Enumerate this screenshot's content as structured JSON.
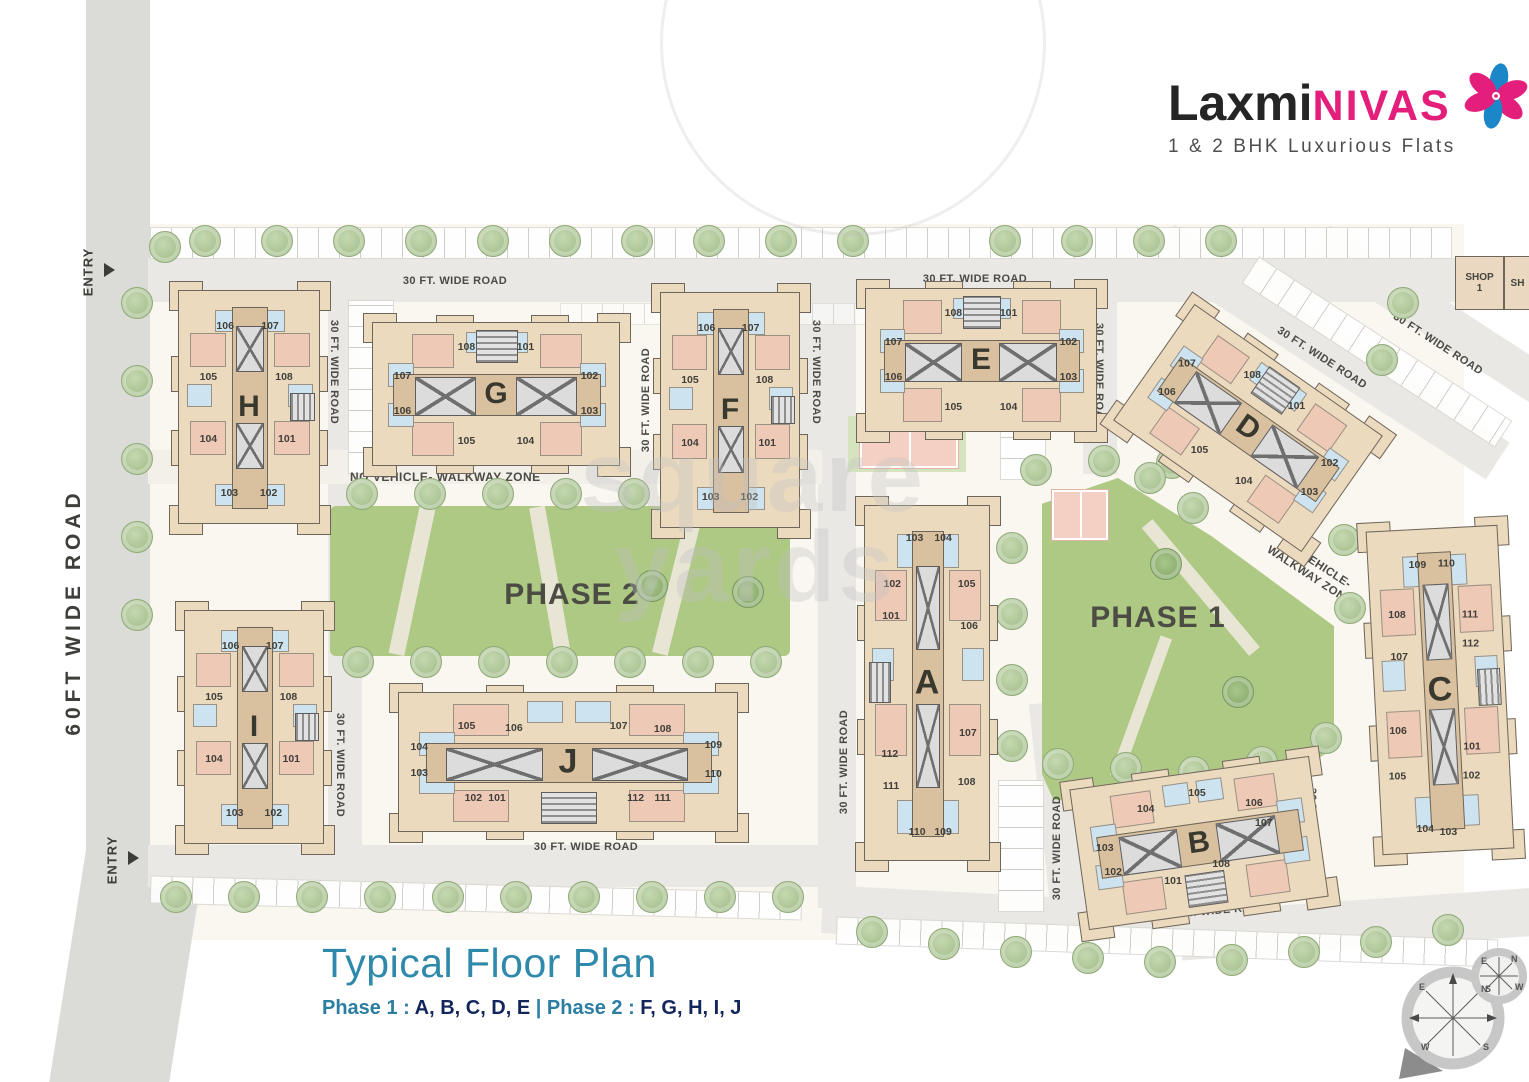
{
  "logo": {
    "name_part1": "Laxmi",
    "name_part2": "NIVAS",
    "tagline": "1 & 2 BHK Luxurious Flats"
  },
  "legend": {
    "title": "Typical Floor Plan",
    "phase1_label": "Phase 1 : ",
    "phase1_buildings": "A, B, C, D, E ",
    "phase2_label": "| Phase 2 : ",
    "phase2_buildings": "F, G, H, I, J"
  },
  "zones": {
    "phase1": "PHASE 1",
    "phase2": "PHASE 2",
    "walkway": "NO VEHICLE- WALKWAY ZONE",
    "walkway_diag_line1": "NO VEHICLE-",
    "walkway_diag_line2": "WALKWAY ZONE"
  },
  "roads": {
    "left_label": "60FT WIDE ROAD",
    "entry_label": "ENTRY",
    "entries": [
      {
        "x": 88,
        "y": 272,
        "ax": 104,
        "ay": 263
      },
      {
        "x": 112,
        "y": 860,
        "ax": 128,
        "ay": 851
      }
    ],
    "labels": [
      {
        "t": "30 FT. WIDE ROAD",
        "x": 455,
        "y": 281,
        "r": 0
      },
      {
        "t": "30 FT. WIDE ROAD",
        "x": 975,
        "y": 279,
        "r": 0
      },
      {
        "t": "30 FT. WIDE ROAD",
        "x": 334,
        "y": 372,
        "r": 90
      },
      {
        "t": "30 FT. WIDE ROAD",
        "x": 646,
        "y": 400,
        "r": -90
      },
      {
        "t": "30 FT. WIDE ROAD",
        "x": 816,
        "y": 372,
        "r": 90
      },
      {
        "t": "30 FT. WIDE ROAD",
        "x": 1099,
        "y": 375,
        "r": 90
      },
      {
        "t": "30 FT. WIDE ROAD",
        "x": 1322,
        "y": 358,
        "r": 33
      },
      {
        "t": "30 FT. WIDE ROAD",
        "x": 1438,
        "y": 344,
        "r": 33
      },
      {
        "t": "30 FT. WIDE ROAD",
        "x": 340,
        "y": 765,
        "r": 90
      },
      {
        "t": "30 FT. WIDE ROAD",
        "x": 586,
        "y": 847,
        "r": 0
      },
      {
        "t": "30 FT. WIDE ROAD",
        "x": 844,
        "y": 762,
        "r": -90
      },
      {
        "t": "30 FT. WIDE ROAD",
        "x": 1057,
        "y": 848,
        "r": -90
      },
      {
        "t": "30 FT. WIDE ROAD",
        "x": 1312,
        "y": 840,
        "r": 90
      },
      {
        "t": "30 FT. WIDE ROAD",
        "x": 1216,
        "y": 911,
        "r": -5
      }
    ]
  },
  "shops": [
    {
      "line1": "SHOP",
      "line2": "1",
      "x": 1455,
      "y": 256,
      "w": 47,
      "h": 52
    },
    {
      "line1": "SH",
      "line2": "",
      "x": 1504,
      "y": 256,
      "w": 25,
      "h": 52
    }
  ],
  "watermark": {
    "line1": "square",
    "line2": "yards"
  },
  "compass": {
    "n": "N",
    "e": "E",
    "s": "S",
    "w": "W"
  },
  "colors": {
    "brand_pink": "#e31f7b",
    "brand_blue": "#1b86c8",
    "title_teal": "#2f89ab",
    "navy": "#13265c",
    "building_tan": "#ecdabf",
    "room_pink": "#eec9b6",
    "room_blue": "#cde3ef",
    "park_green": "#adc983",
    "road_gray": "#e9e8e4"
  },
  "buildings": [
    {
      "id": "H",
      "x": 178,
      "y": 290,
      "w": 142,
      "h": 234,
      "rot": 0,
      "orient": "v",
      "stair": "right",
      "units": [
        {
          "n": "106",
          "x": 33,
          "y": 15
        },
        {
          "n": "107",
          "x": 65,
          "y": 15
        },
        {
          "n": "105",
          "x": 21,
          "y": 37
        },
        {
          "n": "108",
          "x": 75,
          "y": 37
        },
        {
          "n": "104",
          "x": 21,
          "y": 64
        },
        {
          "n": "101",
          "x": 77,
          "y": 64
        },
        {
          "n": "103",
          "x": 36,
          "y": 87
        },
        {
          "n": "102",
          "x": 64,
          "y": 87
        }
      ]
    },
    {
      "id": "G",
      "x": 372,
      "y": 322,
      "w": 248,
      "h": 144,
      "rot": 0,
      "orient": "h",
      "stair": "top",
      "units": [
        {
          "n": "108",
          "x": 38,
          "y": 17
        },
        {
          "n": "101",
          "x": 62,
          "y": 17
        },
        {
          "n": "107",
          "x": 12,
          "y": 37
        },
        {
          "n": "102",
          "x": 88,
          "y": 37
        },
        {
          "n": "106",
          "x": 12,
          "y": 62
        },
        {
          "n": "103",
          "x": 88,
          "y": 62
        },
        {
          "n": "105",
          "x": 38,
          "y": 83
        },
        {
          "n": "104",
          "x": 62,
          "y": 83
        }
      ]
    },
    {
      "id": "F",
      "x": 660,
      "y": 292,
      "w": 140,
      "h": 236,
      "rot": 0,
      "orient": "v",
      "stair": "right",
      "units": [
        {
          "n": "106",
          "x": 33,
          "y": 15
        },
        {
          "n": "107",
          "x": 65,
          "y": 15
        },
        {
          "n": "105",
          "x": 21,
          "y": 37
        },
        {
          "n": "108",
          "x": 75,
          "y": 37
        },
        {
          "n": "104",
          "x": 21,
          "y": 64
        },
        {
          "n": "101",
          "x": 77,
          "y": 64
        },
        {
          "n": "103",
          "x": 36,
          "y": 87
        },
        {
          "n": "102",
          "x": 64,
          "y": 87
        }
      ]
    },
    {
      "id": "E",
      "x": 865,
      "y": 288,
      "w": 232,
      "h": 144,
      "rot": 0,
      "orient": "h",
      "stair": "top",
      "units": [
        {
          "n": "108",
          "x": 38,
          "y": 17
        },
        {
          "n": "101",
          "x": 62,
          "y": 17
        },
        {
          "n": "107",
          "x": 12,
          "y": 37
        },
        {
          "n": "102",
          "x": 88,
          "y": 37
        },
        {
          "n": "106",
          "x": 12,
          "y": 62
        },
        {
          "n": "103",
          "x": 88,
          "y": 62
        },
        {
          "n": "105",
          "x": 38,
          "y": 83
        },
        {
          "n": "104",
          "x": 62,
          "y": 83
        }
      ]
    },
    {
      "id": "D",
      "x": 1133,
      "y": 357,
      "w": 230,
      "h": 142,
      "rot": 35,
      "orient": "h",
      "stair": "top",
      "units": [
        {
          "n": "108",
          "x": 38,
          "y": 17
        },
        {
          "n": "101",
          "x": 62,
          "y": 17
        },
        {
          "n": "107",
          "x": 12,
          "y": 37
        },
        {
          "n": "102",
          "x": 88,
          "y": 37
        },
        {
          "n": "106",
          "x": 12,
          "y": 62
        },
        {
          "n": "103",
          "x": 88,
          "y": 62
        },
        {
          "n": "105",
          "x": 38,
          "y": 83
        },
        {
          "n": "104",
          "x": 62,
          "y": 83
        }
      ]
    },
    {
      "id": "A",
      "x": 864,
      "y": 505,
      "w": 126,
      "h": 356,
      "rot": 0,
      "orient": "v",
      "stair": "left",
      "units": [
        {
          "n": "103",
          "x": 40,
          "y": 9
        },
        {
          "n": "104",
          "x": 63,
          "y": 9
        },
        {
          "n": "102",
          "x": 22,
          "y": 22
        },
        {
          "n": "105",
          "x": 82,
          "y": 22
        },
        {
          "n": "101",
          "x": 21,
          "y": 31
        },
        {
          "n": "106",
          "x": 84,
          "y": 34
        },
        {
          "n": "112",
          "x": 20,
          "y": 70
        },
        {
          "n": "107",
          "x": 83,
          "y": 64
        },
        {
          "n": "111",
          "x": 21,
          "y": 79
        },
        {
          "n": "108",
          "x": 82,
          "y": 78
        },
        {
          "n": "110",
          "x": 42,
          "y": 92
        },
        {
          "n": "109",
          "x": 63,
          "y": 92
        }
      ]
    },
    {
      "id": "B",
      "x": 1078,
      "y": 772,
      "w": 242,
      "h": 142,
      "rot": -8,
      "orient": "h",
      "stair": "bottom",
      "units": [
        {
          "n": "104",
          "x": 30,
          "y": 21
        },
        {
          "n": "105",
          "x": 52,
          "y": 14
        },
        {
          "n": "103",
          "x": 11,
          "y": 44
        },
        {
          "n": "106",
          "x": 75,
          "y": 27
        },
        {
          "n": "102",
          "x": 13,
          "y": 62
        },
        {
          "n": "107",
          "x": 78,
          "y": 42
        },
        {
          "n": "101",
          "x": 37,
          "y": 74
        },
        {
          "n": "108",
          "x": 58,
          "y": 67
        }
      ]
    },
    {
      "id": "C",
      "x": 1374,
      "y": 528,
      "w": 132,
      "h": 324,
      "rot": -3,
      "orient": "v",
      "stair": "right",
      "units": [
        {
          "n": "109",
          "x": 38,
          "y": 11
        },
        {
          "n": "110",
          "x": 60,
          "y": 11
        },
        {
          "n": "108",
          "x": 20,
          "y": 26
        },
        {
          "n": "111",
          "x": 76,
          "y": 27
        },
        {
          "n": "107",
          "x": 20,
          "y": 39
        },
        {
          "n": "112",
          "x": 75,
          "y": 36
        },
        {
          "n": "106",
          "x": 16,
          "y": 62
        },
        {
          "n": "101",
          "x": 72,
          "y": 68
        },
        {
          "n": "105",
          "x": 14,
          "y": 76
        },
        {
          "n": "102",
          "x": 71,
          "y": 77
        },
        {
          "n": "104",
          "x": 33,
          "y": 93
        },
        {
          "n": "103",
          "x": 51,
          "y": 94
        }
      ]
    },
    {
      "id": "I",
      "x": 184,
      "y": 610,
      "w": 140,
      "h": 234,
      "rot": 0,
      "orient": "v",
      "stair": "right",
      "units": [
        {
          "n": "106",
          "x": 33,
          "y": 15
        },
        {
          "n": "107",
          "x": 65,
          "y": 15
        },
        {
          "n": "105",
          "x": 21,
          "y": 37
        },
        {
          "n": "108",
          "x": 75,
          "y": 37
        },
        {
          "n": "104",
          "x": 21,
          "y": 64
        },
        {
          "n": "101",
          "x": 77,
          "y": 64
        },
        {
          "n": "103",
          "x": 36,
          "y": 87
        },
        {
          "n": "102",
          "x": 64,
          "y": 87
        }
      ]
    },
    {
      "id": "J",
      "x": 398,
      "y": 692,
      "w": 340,
      "h": 140,
      "rot": 0,
      "orient": "h",
      "stair": "bottom",
      "units": [
        {
          "n": "105",
          "x": 20,
          "y": 24
        },
        {
          "n": "106",
          "x": 34,
          "y": 25
        },
        {
          "n": "107",
          "x": 65,
          "y": 24
        },
        {
          "n": "108",
          "x": 78,
          "y": 26
        },
        {
          "n": "104",
          "x": 6,
          "y": 39
        },
        {
          "n": "103",
          "x": 6,
          "y": 58
        },
        {
          "n": "109",
          "x": 93,
          "y": 38
        },
        {
          "n": "110",
          "x": 93,
          "y": 59
        },
        {
          "n": "102",
          "x": 22,
          "y": 76
        },
        {
          "n": "101",
          "x": 29,
          "y": 76
        },
        {
          "n": "112",
          "x": 70,
          "y": 76
        },
        {
          "n": "111",
          "x": 78,
          "y": 76
        }
      ]
    }
  ]
}
